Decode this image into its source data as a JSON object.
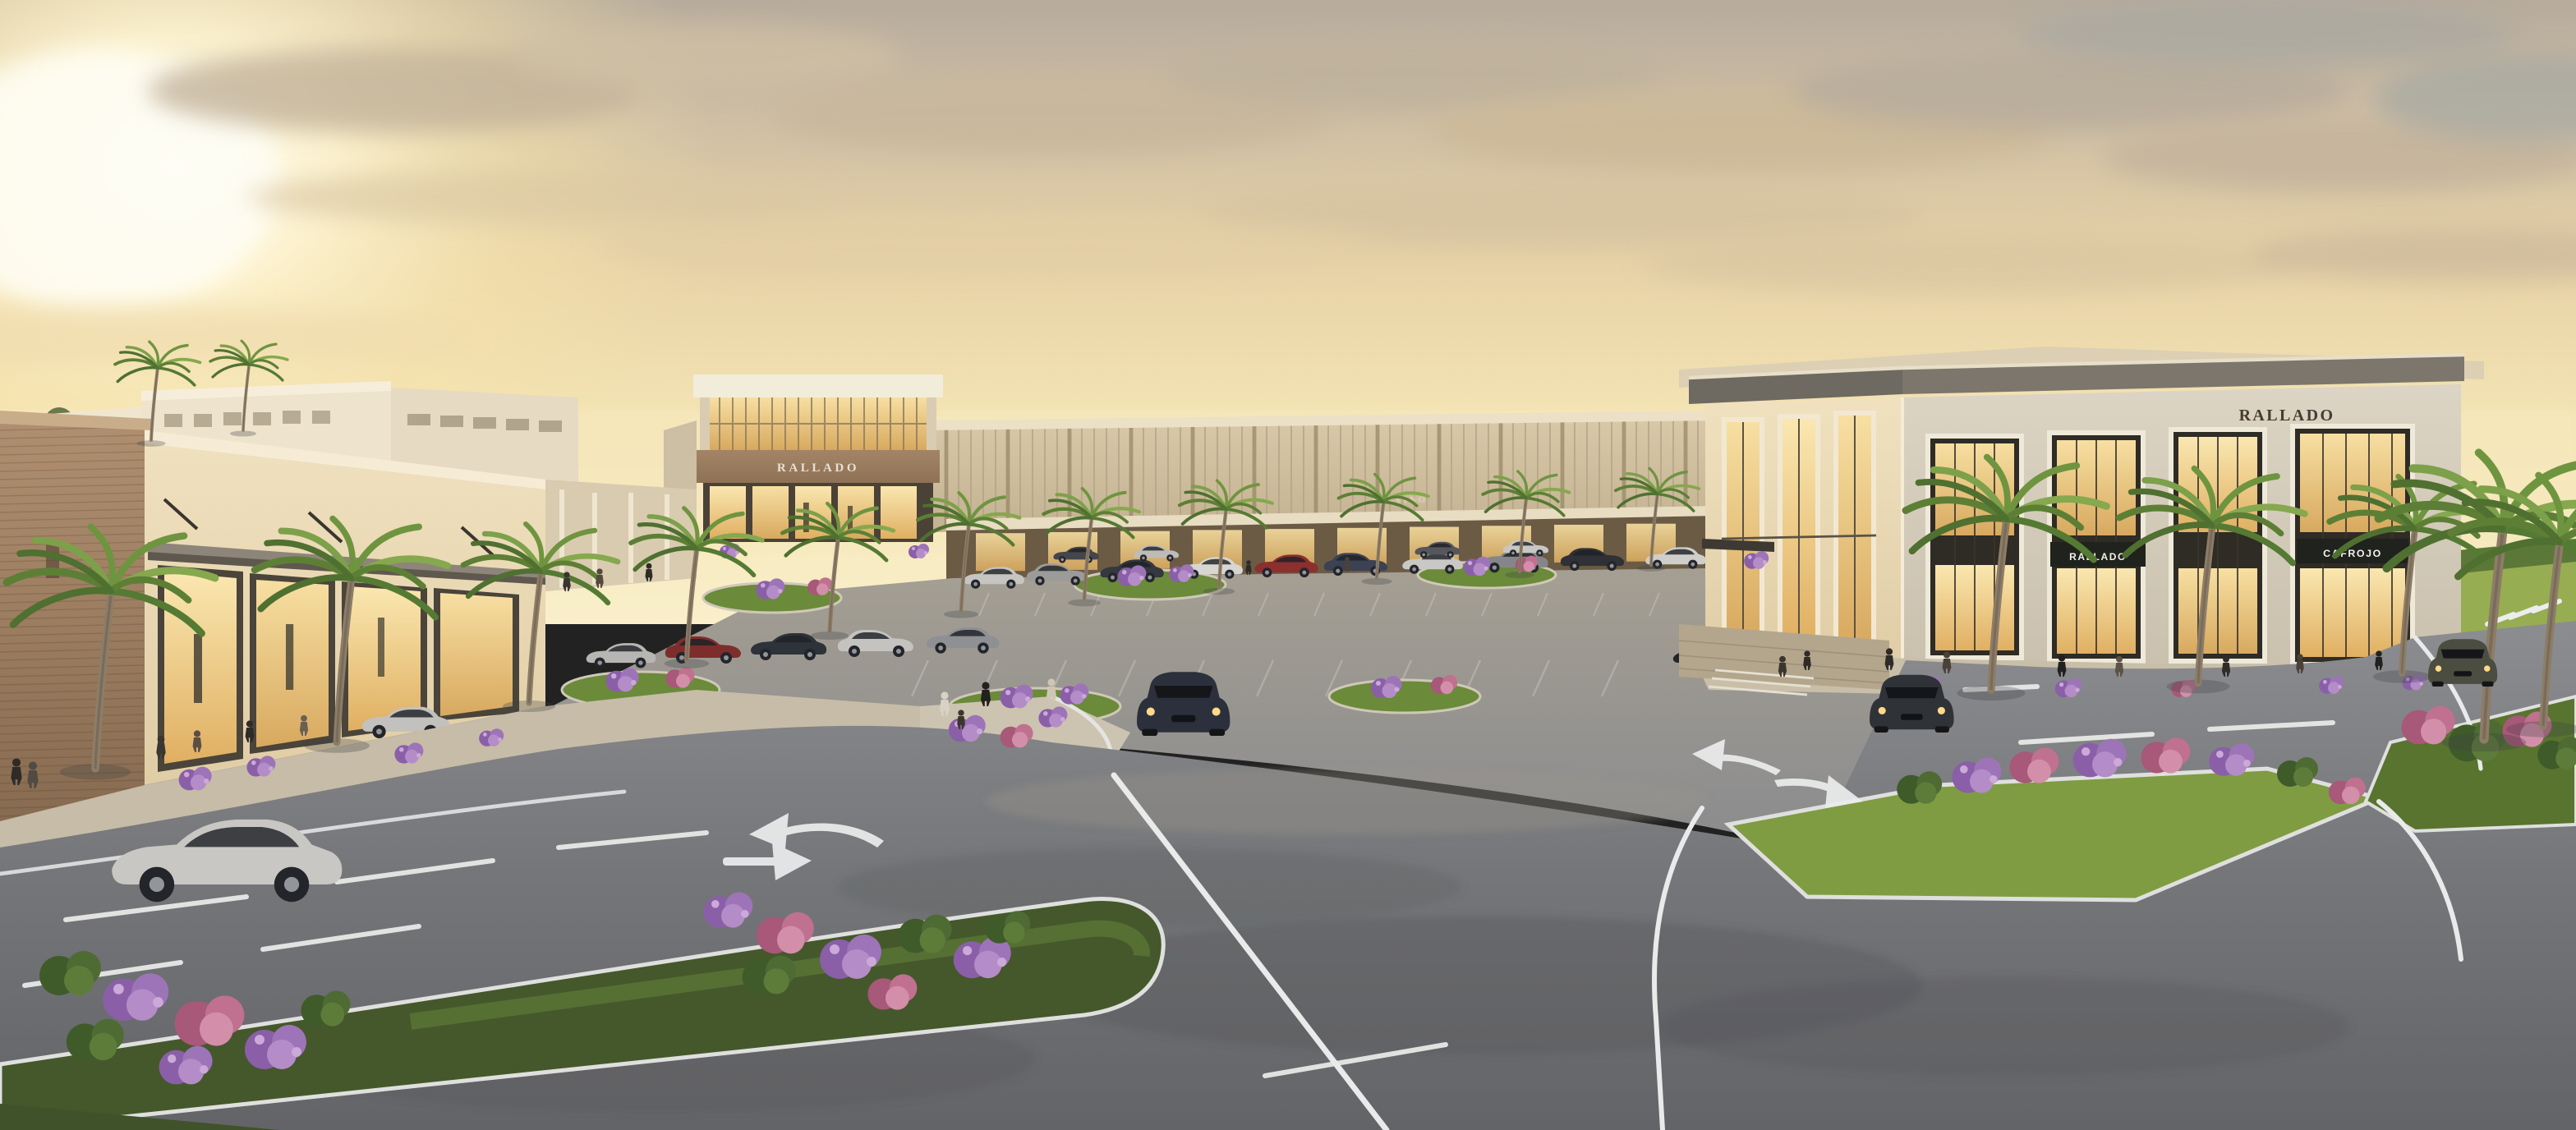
{
  "meta": {
    "title": "Rallado retail plaza — sunset architectural rendering",
    "type": "architectural-rendering",
    "time_of_day": "sunset"
  },
  "signs": {
    "plaza_main": "RALLADO",
    "corner_top": "RALLADO",
    "corner_band_left": "RALLADO",
    "corner_band_right": "CAFROJO",
    "strip_front": "SELVINO"
  },
  "scene": {
    "description": "Sunset rendering of an upscale open-air shopping plaza with a central glass atrium anchor, a long strip of storefronts, a two-story corner retail building, a landscaped parking lot full of cars, palm trees, purple flower medians, roads with painted turn arrows, and pedestrians.",
    "elements": [
      "glowing storefronts",
      "palm trees",
      "parking lot with cars",
      "grass medians with purple and pink flowers",
      "white lane markings and turn arrows",
      "pedestrians",
      "sunset sky with clouds"
    ]
  },
  "colors": {
    "sun_glow": "#fffdf2",
    "sky_warm": "#ecd7a6",
    "cloud": "#c2b29a",
    "stucco": "#ece1c8",
    "brick": "#a1846a",
    "corner_face_grey": "#d7d0c0",
    "roof_fascia": "#7c766c",
    "glass_glow": "#eec77f",
    "sign_band": "#20221d",
    "asphalt": "#808184",
    "grass_lit": "#86a344",
    "grass_shade": "#45582c",
    "flower_purple": "#9d74b8",
    "flower_pink": "#c0718f",
    "palm_green": "#6f9440",
    "marking_white": "#eceded"
  }
}
